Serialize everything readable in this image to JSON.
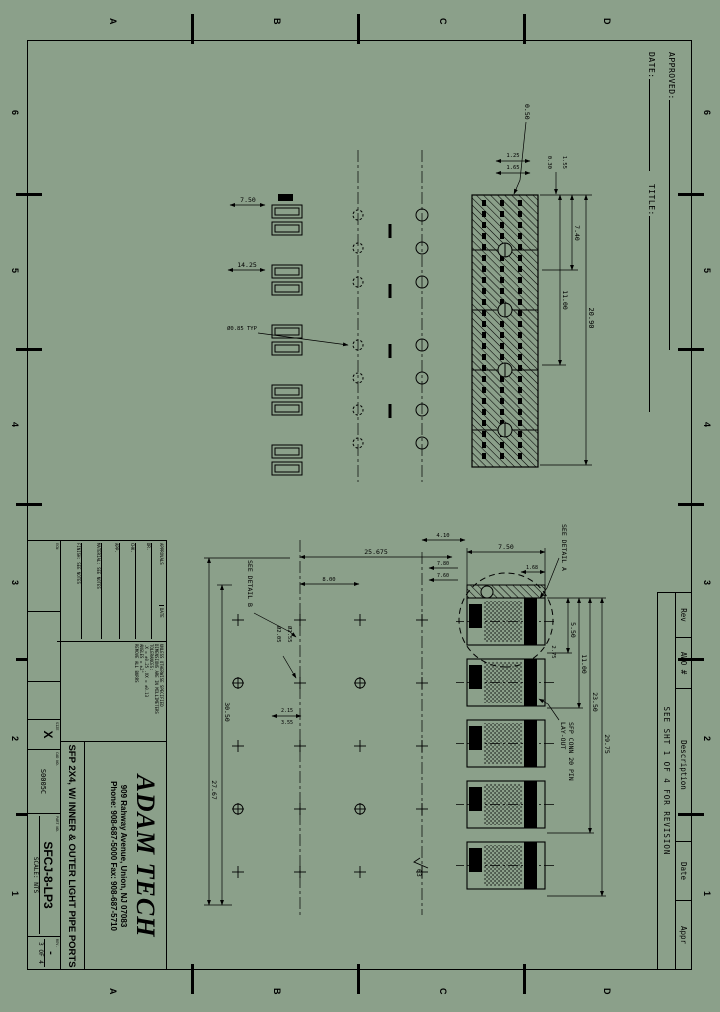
{
  "page": {
    "bg": "#8ba08a",
    "ink": "#000000"
  },
  "zones": {
    "numbers": [
      "6",
      "5",
      "4",
      "3",
      "2",
      "1"
    ],
    "letters": [
      "D",
      "C",
      "B",
      "A"
    ]
  },
  "approval": {
    "approved_label": "APPROVED:",
    "date_label": "DATE:",
    "title_label": "TITLE:"
  },
  "rev_table": {
    "headers": [
      "Rev",
      "AWO #",
      "Description",
      "Date",
      "Appr"
    ],
    "note": "SEE SHT 1 OF 4 FOR REVISION"
  },
  "title_block": {
    "company": "ADAM TECH",
    "address": "909 Rahway Avenue, Union, NJ 07083",
    "phone": "Phone: 908-687-5000 Fax: 908-687-5710",
    "drawing_title": "SFP 2X4, W/ INNER & OUTER LIGHT PIPE PORTS",
    "part_number": "SFCJ-8-LP3",
    "size_label": "SIZE",
    "size": "X",
    "cad_label": "CAD NO.",
    "cad_no": "S0005C",
    "part_label": "PART NO.",
    "scale_label": "SCALE:",
    "scale": "NTS",
    "sheet_label": "SHT",
    "sheet": "3",
    "of_label": "OF",
    "sheet_of": "4",
    "rev_label": "REV.",
    "rev": "-",
    "notes": [
      "UNLESS OTHERWISE SPECIFIED",
      "DIMENSIONS ARE IN MILLIMETERS",
      "TOLERANCES:",
      ".X = ±0.25  .XX = ±0.13",
      "ANGLES = ±2°",
      "REMOVE ALL BURRS"
    ],
    "approvals_header_1": "APPROVALS",
    "approvals_header_2": "DATE",
    "approvals_rows": [
      "DR.",
      "CHK.",
      "APP."
    ],
    "misc_1": "MATERIAL: SEE NOTES",
    "misc_2": "FINISH: SEE NOTES",
    "misc_3": "ECN"
  },
  "view1": {
    "dims": {
      "d2090": "20.90",
      "d1100": "11.00",
      "d740": "7.40",
      "d155": "1.55",
      "d030": "0.30",
      "d125": "1.25",
      "d165": "1.65",
      "d050": "0.50",
      "d750": "7.50",
      "d1425": "14.25",
      "dhole": "Ø0.85 TYP"
    }
  },
  "view2": {
    "dims": {
      "d550": "5.50",
      "d1100": "11.00",
      "d2350": "23.50",
      "d2975": "29.75",
      "d275": "2.75",
      "d750": "7.50",
      "d168": "1.68",
      "d410": "4.10",
      "d780": "7.80",
      "d760": "7.60",
      "d25675": "25.675",
      "d800": "8.00",
      "d215": "2.15",
      "d355": "3.55",
      "dh255": "Ø2.55",
      "dh205": "Ø2.05",
      "d3050": "30.50",
      "d2767": "27.67",
      "f63": "63"
    },
    "notes": {
      "detail_a": "SEE DETAIL A",
      "detail_b": "SEE DETAIL B",
      "conn1": "SFP CONN 20 PIN",
      "conn2": "LAY-OUT"
    }
  }
}
